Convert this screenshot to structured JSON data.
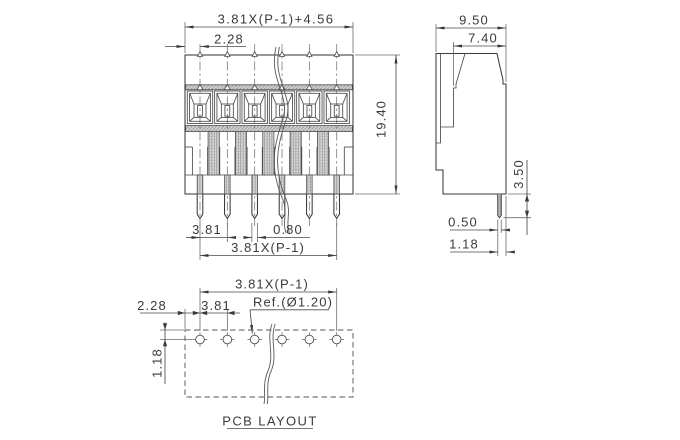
{
  "front_view": {
    "dim_total_width": "3.81X(P-1)+4.56",
    "dim_left_margin": "2.28",
    "dim_height": "19.40",
    "dim_pin_pitch": "3.81",
    "dim_pin_width": "0.80",
    "dim_pin_span": "3.81X(P-1)"
  },
  "side_view": {
    "dim_total_depth": "9.50",
    "dim_upper_depth": "7.40",
    "dim_pin_length": "3.50",
    "dim_pin_thickness": "0.50",
    "dim_pin_edge_offset": "1.18"
  },
  "pcb_layout": {
    "title": "PCB LAYOUT",
    "dim_hole_span": "3.81X(P-1)",
    "dim_left_margin": "2.28",
    "dim_hole_pitch": "3.81",
    "dim_row_offset": "1.18",
    "hole_diameter_ref": "Ref.(Ø1.20)"
  }
}
